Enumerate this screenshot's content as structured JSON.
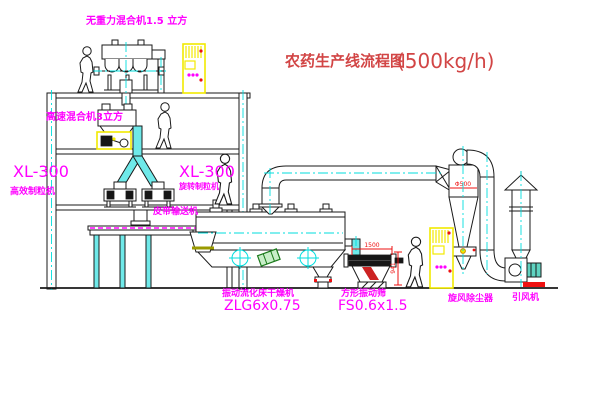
{
  "title": {
    "cn": "农药生产线流程图",
    "capacity": "(500kg/h)"
  },
  "labels": {
    "gravity_mixer": "无重力混合机1.5 立方",
    "high_speed_mixer": "高速混合机3立方",
    "granulator_left_model": "XL-300",
    "granulator_left_name": "高效制粒机",
    "granulator_mid_model": "XL-300",
    "granulator_mid_name": "旋转制粒机",
    "belt_conveyor": "皮带输送机",
    "dryer_name": "振动流化床干燥机",
    "dryer_model": "ZLG6x0.75",
    "screen_name": "方形振动筛",
    "screen_model": "FS0.6x1.5",
    "cyclone": "旋风除尘器",
    "fan": "引风机"
  },
  "dimensions": {
    "screen_width": "1500",
    "screen_height": "941",
    "cyclone_dia": "Φ500"
  },
  "colors": {
    "label": "#ff00ff",
    "title": "#d24545",
    "dimension": "#ee1111",
    "centerline": "#00dede",
    "pipe": "#6fe9e9",
    "cabinet": "#f2ea00",
    "line": "#1a1a1a"
  }
}
